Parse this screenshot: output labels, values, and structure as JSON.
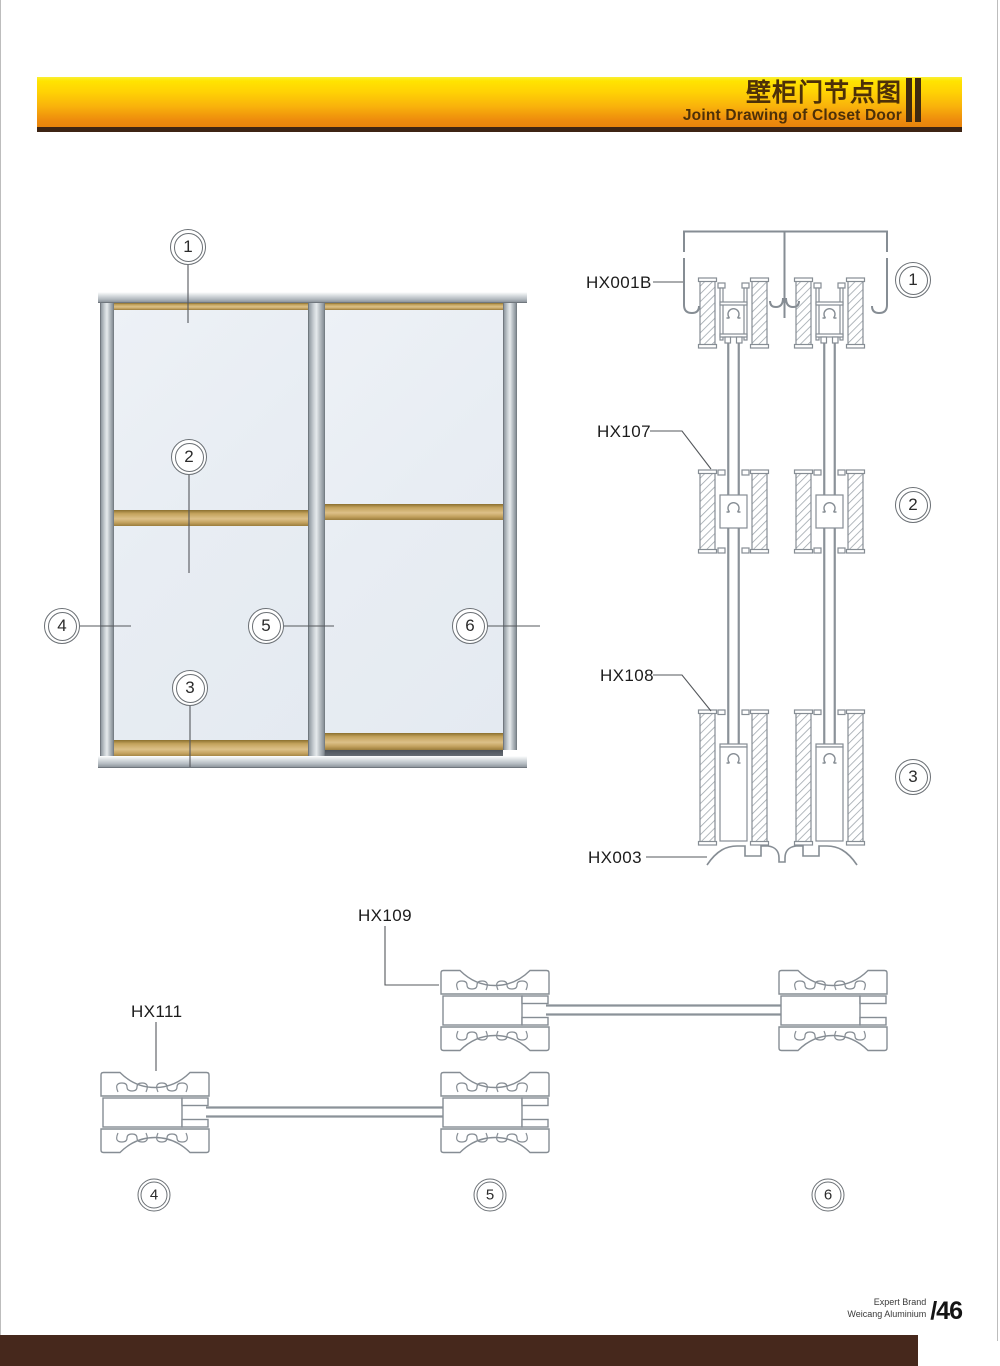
{
  "header": {
    "title_cn": "壁柜门节点图",
    "title_en": "Joint Drawing of Closet Door"
  },
  "labels": {
    "hx001b": "HX001B",
    "hx107": "HX107",
    "hx108": "HX108",
    "hx003": "HX003",
    "hx109": "HX109",
    "hx111": "HX111"
  },
  "callouts": {
    "c1": "1",
    "c2": "2",
    "c3": "3",
    "c4": "4",
    "c5": "5",
    "c6": "6",
    "s1": "1",
    "s2": "2",
    "s3": "3",
    "p4": "4",
    "p5": "5",
    "p6": "6"
  },
  "footer": {
    "brand_line1": "Expert Brand",
    "brand_line2": "Weicang Aluminium",
    "page_number": "/46"
  },
  "colors": {
    "band_top": "#ffe400",
    "band_bottom": "#e8830c",
    "band_underline": "#3d2414",
    "title_text": "#4d3008",
    "footer_bar": "#46281c",
    "drawing_line": "#868d94",
    "wood": "#c3a25c",
    "glass": "#e9eef3"
  }
}
